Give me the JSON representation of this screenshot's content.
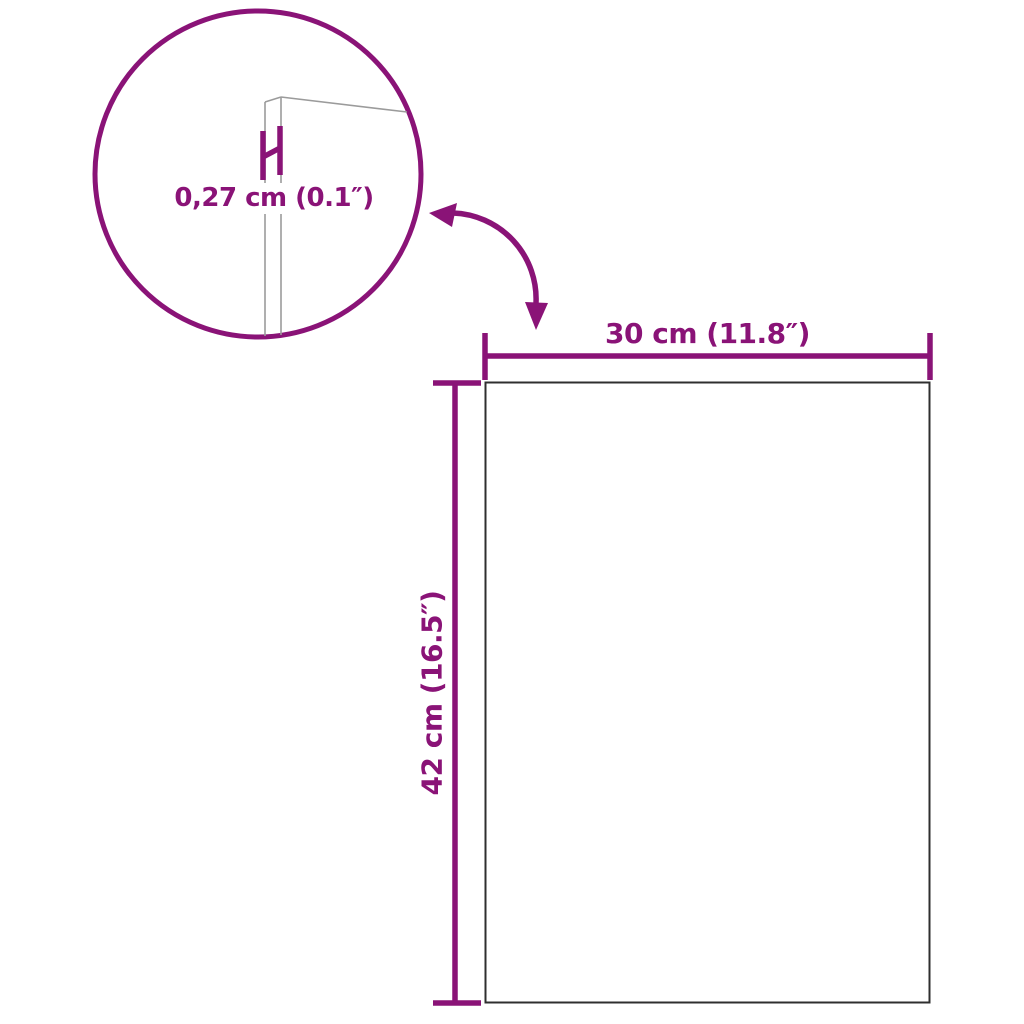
{
  "diagram": {
    "type": "product-dimension-diagram",
    "labels": {
      "thickness": "0,27 cm (0.1″)",
      "width": "30 cm (11.8″)",
      "height": "42 cm (16.5″)"
    },
    "colors": {
      "accent": "#8A1377",
      "panel_outline": "#2F2F2F",
      "edge_detail_line": "#9B9B9B",
      "background": "#FFFFFF"
    },
    "icons": [
      "magnifier-circle",
      "curved-arrow-icon",
      "thickness-marker"
    ]
  }
}
